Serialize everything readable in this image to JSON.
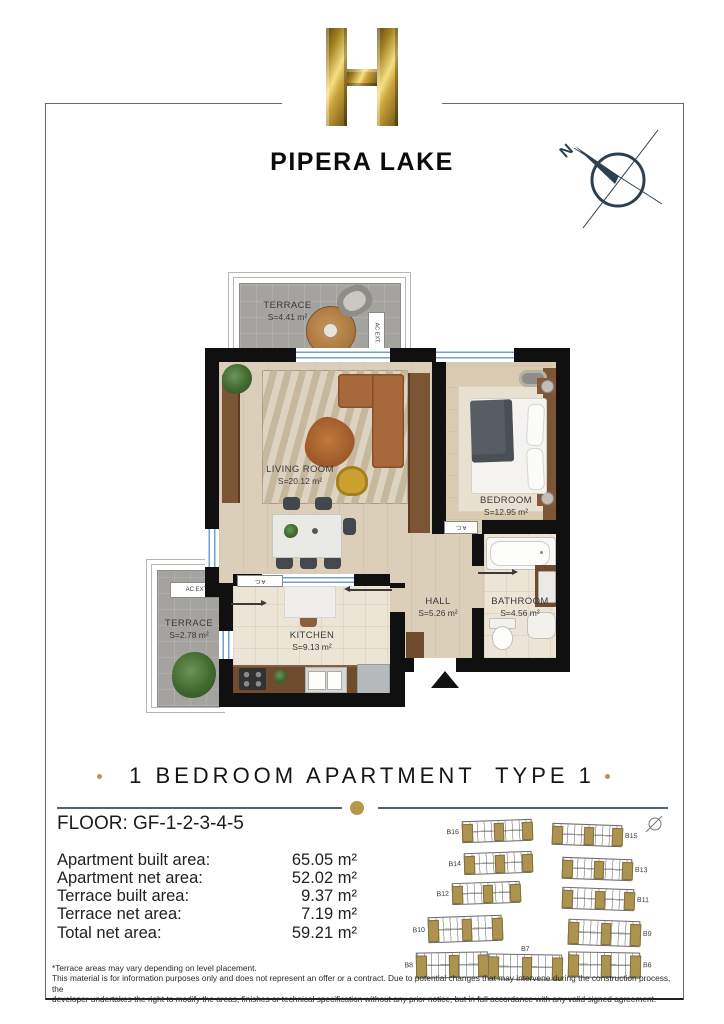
{
  "brand": {
    "logo_letter": "H",
    "name": "PIPERA LAKE"
  },
  "compass": {
    "north_label": "N"
  },
  "plan": {
    "rooms": [
      {
        "id": "terrace-top",
        "name": "TERRACE",
        "area": "S=4.41 m²"
      },
      {
        "id": "living-room",
        "name": "LIVING ROOM",
        "area": "S=20.12 m²"
      },
      {
        "id": "bedroom",
        "name": "BEDROOM",
        "area": "S=12.95 m²"
      },
      {
        "id": "kitchen",
        "name": "KITCHEN",
        "area": "S=9.13 m²"
      },
      {
        "id": "hall",
        "name": "HALL",
        "area": "S=5.26 m²"
      },
      {
        "id": "bathroom",
        "name": "BATHROOM",
        "area": "S=4.56 m²"
      },
      {
        "id": "terrace-left",
        "name": "TERRACE",
        "area": "S=2.78 m²"
      }
    ],
    "labels": {
      "ac_ext": "AC EXT.",
      "ac": "A.C."
    }
  },
  "title": "1 BEDROOM APARTMENT  TYPE 1",
  "floor_label": "FLOOR: GF-1-2-3-4-5",
  "areas": [
    {
      "label": "Apartment built area:",
      "value": "65.05 m²"
    },
    {
      "label": "Apartment net area:",
      "value": "52.02 m²"
    },
    {
      "label": "Terrace built area:",
      "value": "9.37 m²"
    },
    {
      "label": "Terrace net area:",
      "value": "7.19 m²"
    },
    {
      "label": "Total net area:",
      "value": "59.21 m²"
    }
  ],
  "siteplan": {
    "buildings": [
      {
        "label": "B16",
        "side": "left"
      },
      {
        "label": "B15",
        "side": "right"
      },
      {
        "label": "B14",
        "side": "left"
      },
      {
        "label": "B13",
        "side": "right"
      },
      {
        "label": "B12",
        "side": "left"
      },
      {
        "label": "B11",
        "side": "right"
      },
      {
        "label": "B10",
        "side": "left"
      },
      {
        "label": "B9",
        "side": "right"
      },
      {
        "label": "B8",
        "side": "left"
      },
      {
        "label": "B7",
        "side": "top"
      },
      {
        "label": "B6",
        "side": "right"
      }
    ]
  },
  "footer": {
    "line1": "*Terrace areas may vary depending on level placement.",
    "line2": "This material is for information purposes only and does not represent an offer or a contract. Due to potential changes that may intervene during the construction process, the",
    "line3": "developer undertakes the right to modify the areas, finishes or technical specification without any prior notice, but in full accordance with any valid signed agreement."
  },
  "colors": {
    "gold": "#b5964a",
    "wall": "#101010",
    "window_blue": "#6f9fd8",
    "divider": "#55636e"
  }
}
